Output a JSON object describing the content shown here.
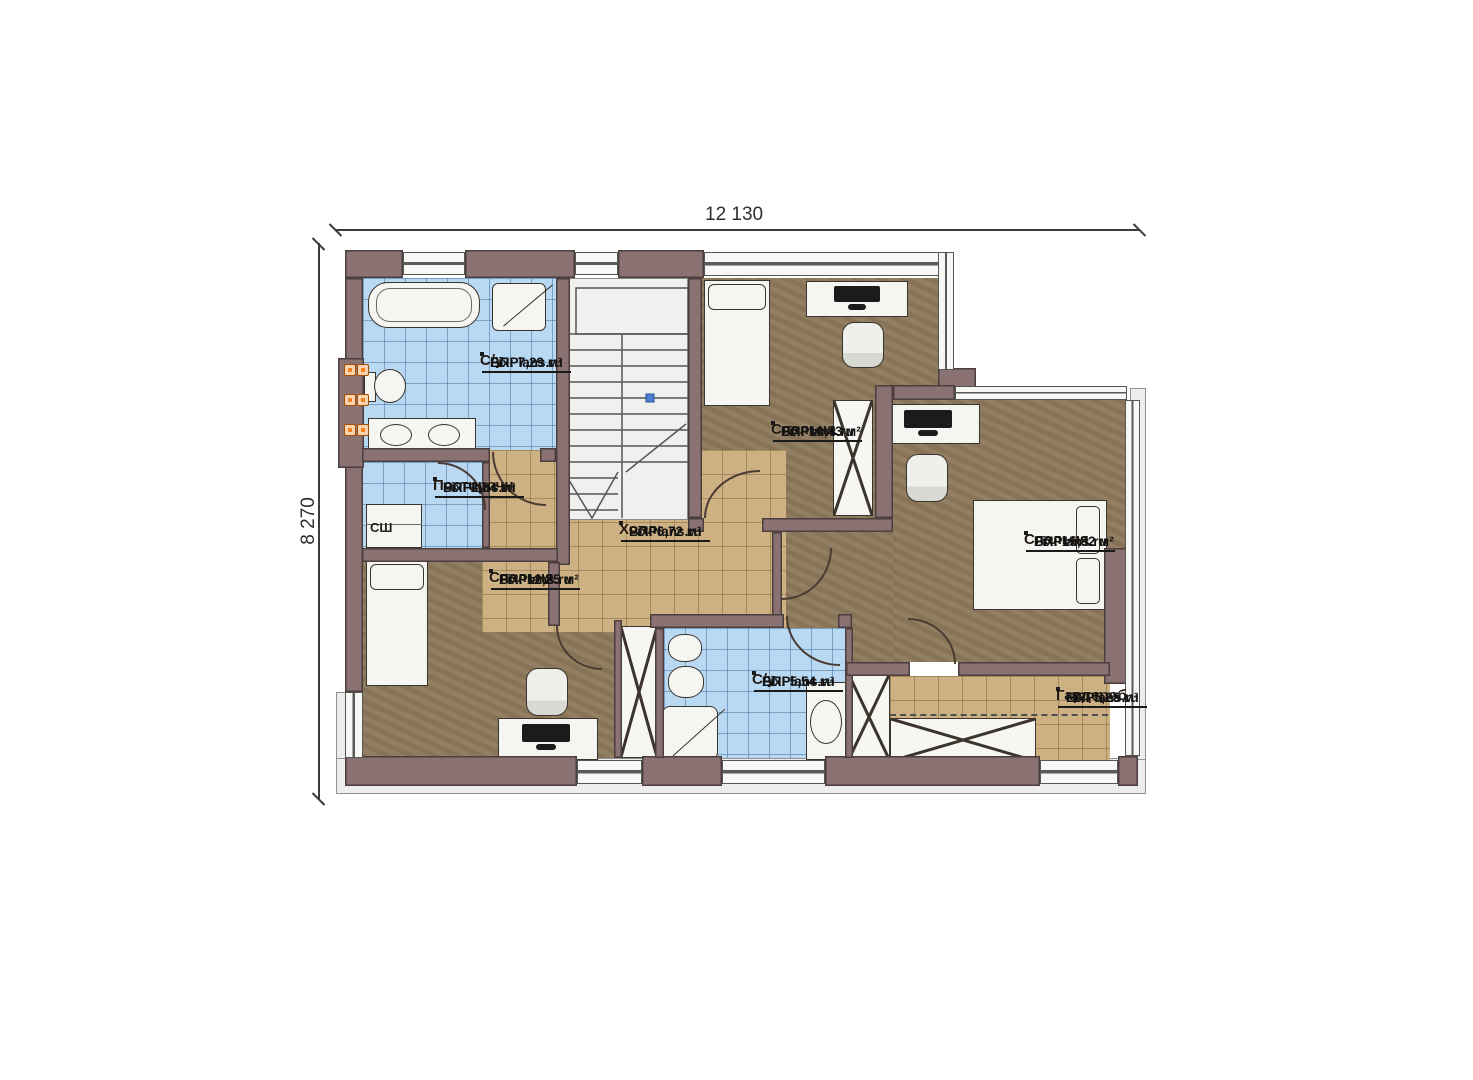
{
  "plan": {
    "dimensions": {
      "width": "12 130",
      "height": "8 270"
    },
    "rooms": [
      {
        "key": "bathroom-top",
        "name": "С/у",
        "brand": "FixPlans.ru",
        "area": "ВП: 7,29 м²"
      },
      {
        "key": "laundry",
        "name": "Постирочн",
        "brand": "FixPlans.ru",
        "area": "ВП: 2,84 м²",
        "note": "СШ"
      },
      {
        "key": "hall",
        "name": "Холл",
        "brand": "FixPlans.ru",
        "area": "ВП: 6,72 м²"
      },
      {
        "key": "bedroom-top",
        "name": "Спальня",
        "brand": "FixPlans.ru",
        "area": "ВП: 10,43 м²"
      },
      {
        "key": "bedroom-right",
        "name": "Спальня",
        "brand": "FixPlans.ru",
        "area": "ВП: 15,92 м²"
      },
      {
        "key": "bedroom-left",
        "name": "Спальня",
        "brand": "FixPlans.ru",
        "area": "ВП: 12,25 м²"
      },
      {
        "key": "bathroom-bottom",
        "name": "С/у",
        "brand": "FixPlans.ru",
        "area": "ВП: 5,54 м²"
      },
      {
        "key": "wardrobe",
        "name": "Гардероб",
        "brand": "FixPlans.ru",
        "area": "ВП: 5,25 м²"
      }
    ],
    "colors": {
      "wall": "#8a7272",
      "tile_blue": "#b9d8f2",
      "tile_tan": "#cdb183",
      "floor_brown": "#8e7a5c",
      "accent_orange": "#f08222"
    }
  }
}
